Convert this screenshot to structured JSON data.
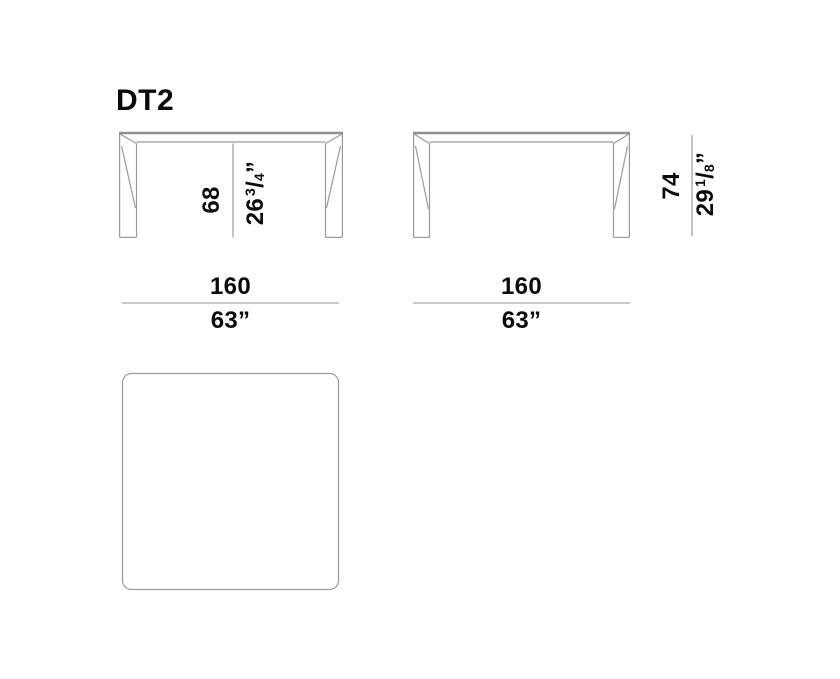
{
  "title": "DT2",
  "colors": {
    "background": "#ffffff",
    "drawing_line": "#9b9b9b",
    "tabletop_edge_line": "#8f8f8f",
    "text": "#0c0c0c"
  },
  "front_view": {
    "clearance_height": {
      "cm": "68",
      "in_whole": "26",
      "in_frac_num": "3",
      "in_frac_slash": "/",
      "in_frac_den": "4",
      "in_mark": "”"
    },
    "width": {
      "cm": "160",
      "inches": "63”"
    }
  },
  "side_view": {
    "overall_height": {
      "cm": "74",
      "in_whole": "29",
      "in_frac_num": "1",
      "in_frac_slash": "/",
      "in_frac_den": "8",
      "in_mark": "”"
    },
    "width": {
      "cm": "160",
      "inches": "63”"
    }
  }
}
